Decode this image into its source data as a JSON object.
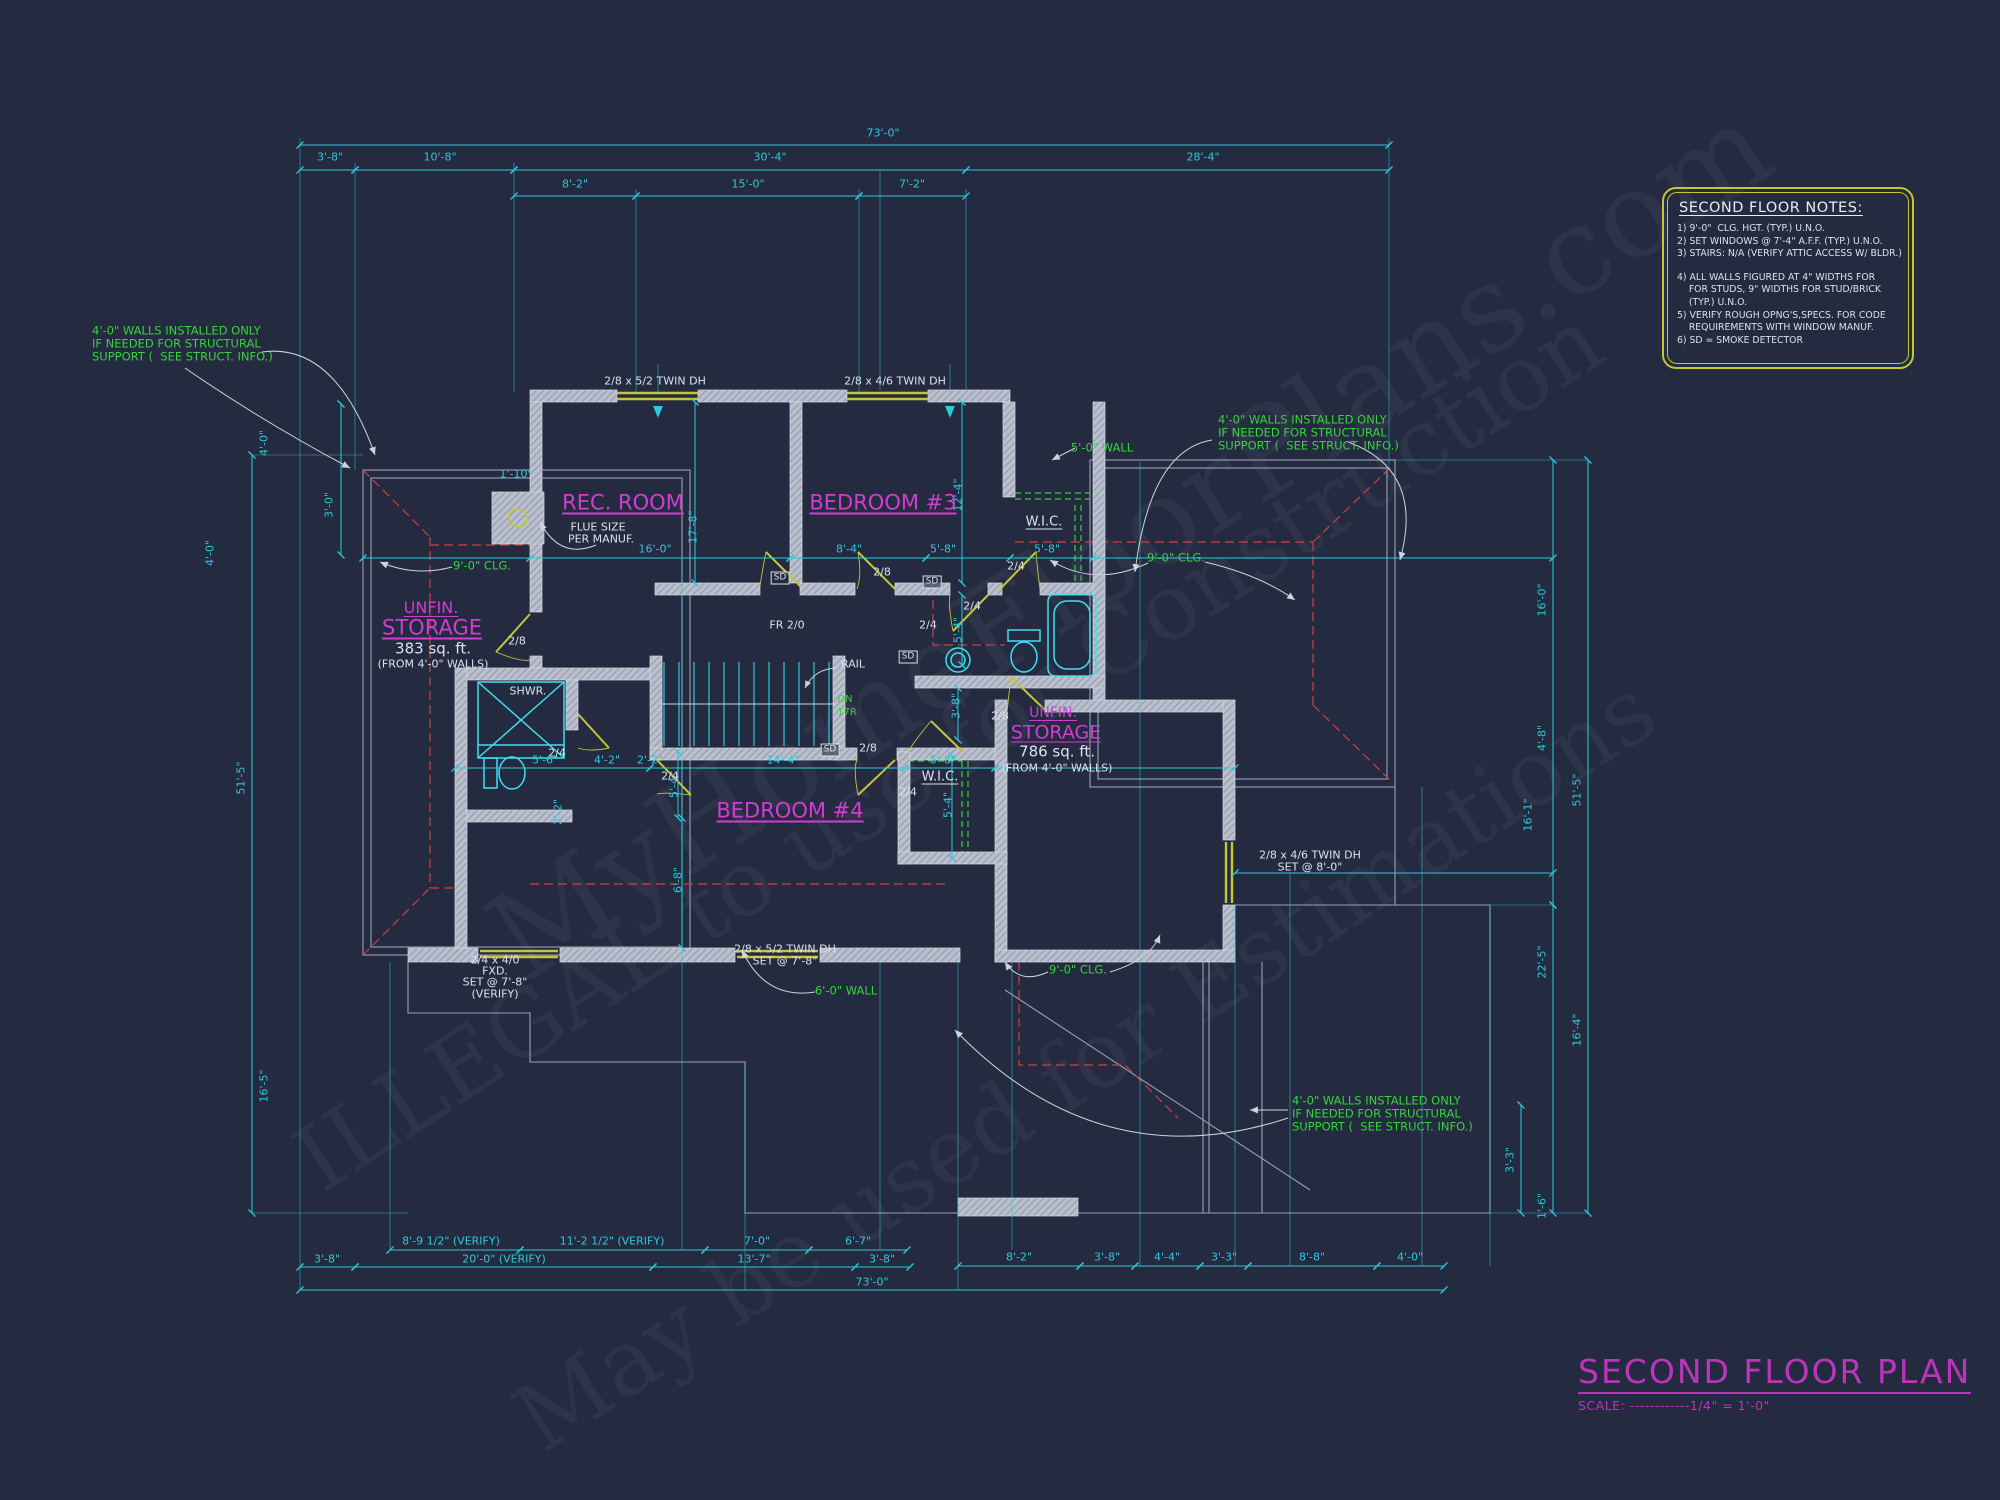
{
  "colors": {
    "background": "#242b40",
    "dimension_cyan": "#2cc8da",
    "label_white": "#dde1ec",
    "note_green": "#35d43a",
    "room_magenta": "#d33cd3",
    "door_window_yellow": "#c6c635",
    "ceiling_red": "#cf4040",
    "wall_gray": "#c2c7d4"
  },
  "title_block": {
    "title": "SECOND FLOOR PLAN",
    "scale": "SCALE: ------------1/4\" = 1'-0\""
  },
  "notes_box": {
    "title": "SECOND FLOOR NOTES:",
    "lines": [
      {
        "t": "1) 9'-0\"  CLG. HGT. (TYP.) U.N.O."
      },
      {
        "t": "2) SET WINDOWS @ 7'-4\" A.F.F. (TYP.) U.N.O."
      },
      {
        "t": "3) STAIRS: N/A (VERIFY ATTIC ACCESS W/ BLDR.)"
      },
      {
        "t": "4) ALL WALLS FIGURED AT 4\" WIDTHS FOR",
        "gap": true
      },
      {
        "t": "    FOR STUDS, 9\" WIDTHS FOR STUD/BRICK"
      },
      {
        "t": "    (TYP.) U.N.O."
      },
      {
        "t": "5) VERIFY ROUGH OPNG'S,SPECS. FOR CODE"
      },
      {
        "t": "    REQUIREMENTS WITH WINDOW MANUF."
      },
      {
        "t": "6) SD = SMOKE DETECTOR"
      }
    ]
  },
  "rooms": [
    {
      "t": "REC. ROOM",
      "x": 623,
      "y": 503,
      "f": 21,
      "cls": "ul",
      "n": "room-label-rec-room"
    },
    {
      "t": "BEDROOM #3",
      "x": 883,
      "y": 503,
      "f": 21,
      "cls": "ul",
      "n": "room-label-bedroom-3"
    },
    {
      "t": "BEDROOM #4",
      "x": 790,
      "y": 811,
      "f": 21,
      "cls": "ul",
      "n": "room-label-bedroom-4"
    },
    {
      "t": "UNFIN.",
      "x": 431,
      "y": 608,
      "f": 16,
      "cls": "ul",
      "n": "room-label-unfin-storage-left"
    },
    {
      "t": "STORAGE",
      "x": 432,
      "y": 628,
      "f": 21,
      "cls": "ul",
      "n": "room-label-unfin-storage-left"
    },
    {
      "t": "UNFIN.",
      "x": 1053,
      "y": 713,
      "f": 14,
      "cls": "ul",
      "n": "room-label-unfin-storage-right"
    },
    {
      "t": "STORAGE",
      "x": 1056,
      "y": 733,
      "f": 19,
      "cls": "ul",
      "n": "room-label-unfin-storage-right"
    }
  ],
  "white_labels": [
    {
      "t": "2/8 x 5/2 TWIN DH",
      "x": 655,
      "y": 381,
      "n": "window-spec"
    },
    {
      "t": "2/8 x 4/6 TWIN DH",
      "x": 895,
      "y": 381,
      "n": "window-spec"
    },
    {
      "t": "FLUE SIZE",
      "x": 598,
      "y": 527,
      "n": "flue-note"
    },
    {
      "t": "PER MANUF.",
      "x": 601,
      "y": 539,
      "n": "flue-note"
    },
    {
      "t": "SHWR.",
      "x": 528,
      "y": 691,
      "n": "fixture-label-shower"
    },
    {
      "t": "W.I.C.",
      "x": 1044,
      "y": 522,
      "f": 13,
      "cls": "ul",
      "n": "room-label-wic-1"
    },
    {
      "t": "W.I.C.",
      "x": 940,
      "y": 777,
      "f": 13,
      "cls": "ul",
      "n": "room-label-wic-2"
    },
    {
      "t": "RAIL",
      "x": 853,
      "y": 664,
      "n": "stair-rail-label"
    },
    {
      "t": "383 sq. ft.",
      "x": 433,
      "y": 649,
      "f": 15,
      "n": "area-label"
    },
    {
      "t": "(FROM 4'-0\" WALLS)",
      "x": 433,
      "y": 664,
      "n": "area-label"
    },
    {
      "t": "786 sq. ft.",
      "x": 1057,
      "y": 752,
      "f": 15,
      "n": "area-label"
    },
    {
      "t": "(FROM 4'-0\" WALLS)",
      "x": 1057,
      "y": 768,
      "n": "area-label"
    },
    {
      "t": "2/4 x 4/0",
      "x": 495,
      "y": 960,
      "n": "window-spec"
    },
    {
      "t": "FXD.",
      "x": 495,
      "y": 971,
      "n": "window-spec"
    },
    {
      "t": "SET @ 7'-8\"",
      "x": 495,
      "y": 982,
      "n": "window-spec"
    },
    {
      "t": "(VERIFY)",
      "x": 495,
      "y": 994,
      "n": "window-spec"
    },
    {
      "t": "2/8 x 5/2 TWIN DH",
      "x": 785,
      "y": 949,
      "n": "window-spec"
    },
    {
      "t": "SET @ 7'-8\"",
      "x": 785,
      "y": 961,
      "n": "window-spec"
    },
    {
      "t": "2/8 x 4/6 TWIN DH",
      "x": 1310,
      "y": 855,
      "n": "window-spec"
    },
    {
      "t": "SET @ 8'-0\"",
      "x": 1310,
      "y": 867,
      "n": "window-spec"
    },
    {
      "t": "2/8",
      "x": 517,
      "y": 641,
      "n": "door-size"
    },
    {
      "t": "2/8",
      "x": 882,
      "y": 572,
      "n": "door-size"
    },
    {
      "t": "2/4",
      "x": 1016,
      "y": 566,
      "n": "door-size"
    },
    {
      "t": "2/4",
      "x": 972,
      "y": 606,
      "n": "door-size"
    },
    {
      "t": "2/4",
      "x": 928,
      "y": 625,
      "n": "door-size"
    },
    {
      "t": "FR 2/0",
      "x": 787,
      "y": 625,
      "n": "door-size"
    },
    {
      "t": "2/8",
      "x": 868,
      "y": 748,
      "n": "door-size"
    },
    {
      "t": "2/8",
      "x": 1000,
      "y": 716,
      "n": "door-size"
    },
    {
      "t": "2/4",
      "x": 670,
      "y": 776,
      "n": "door-size"
    },
    {
      "t": "2/4",
      "x": 908,
      "y": 792,
      "n": "door-size"
    },
    {
      "t": "2/4",
      "x": 557,
      "y": 753,
      "n": "door-size"
    }
  ],
  "green_labels": [
    {
      "t": "9'-0\" CLG.",
      "x": 482,
      "y": 566,
      "n": "ceiling-note"
    },
    {
      "t": "9'-0\" CLG.",
      "x": 1176,
      "y": 558,
      "n": "ceiling-note"
    },
    {
      "t": "9'-0\" CLG.",
      "x": 1078,
      "y": 970,
      "n": "ceiling-note"
    },
    {
      "t": "5'-0\" WALL",
      "x": 1102,
      "y": 448,
      "n": "wall-height-note"
    },
    {
      "t": "6'-0\" WALL",
      "x": 846,
      "y": 991,
      "n": "wall-height-note"
    },
    {
      "t": "DN",
      "x": 845,
      "y": 700,
      "f": 10,
      "n": "stair-direction"
    },
    {
      "t": "17R",
      "x": 847,
      "y": 713,
      "f": 10,
      "n": "stair-risers"
    },
    {
      "t": "4'-0\" WALLS INSTALLED ONLY",
      "x": 92,
      "y": 331,
      "cls": "ta-l",
      "n": "structural-note"
    },
    {
      "t": "IF NEEDED FOR STRUCTURAL",
      "x": 92,
      "y": 344,
      "cls": "ta-l",
      "n": "structural-note"
    },
    {
      "t": "SUPPORT (  SEE STRUCT. INFO.)",
      "x": 92,
      "y": 357,
      "cls": "ta-l",
      "n": "structural-note"
    },
    {
      "t": "4'-0\" WALLS INSTALLED ONLY",
      "x": 1218,
      "y": 420,
      "cls": "ta-l",
      "n": "structural-note"
    },
    {
      "t": "IF NEEDED FOR STRUCTURAL",
      "x": 1218,
      "y": 433,
      "cls": "ta-l",
      "n": "structural-note"
    },
    {
      "t": "SUPPORT (  SEE STRUCT. INFO.)",
      "x": 1218,
      "y": 446,
      "cls": "ta-l",
      "n": "structural-note"
    },
    {
      "t": "4'-0\" WALLS INSTALLED ONLY",
      "x": 1292,
      "y": 1101,
      "cls": "ta-l",
      "n": "structural-note"
    },
    {
      "t": "IF NEEDED FOR STRUCTURAL",
      "x": 1292,
      "y": 1114,
      "cls": "ta-l",
      "n": "structural-note"
    },
    {
      "t": "SUPPORT (  SEE STRUCT. INFO.)",
      "x": 1292,
      "y": 1127,
      "cls": "ta-l",
      "n": "structural-note"
    }
  ],
  "dim_labels": [
    {
      "t": "73'-0\"",
      "x": 883,
      "y": 133
    },
    {
      "t": "3'-8\"",
      "x": 330,
      "y": 157
    },
    {
      "t": "10'-8\"",
      "x": 440,
      "y": 157
    },
    {
      "t": "30'-4\"",
      "x": 770,
      "y": 157
    },
    {
      "t": "28'-4\"",
      "x": 1203,
      "y": 157
    },
    {
      "t": "8'-2\"",
      "x": 575,
      "y": 184
    },
    {
      "t": "15'-0\"",
      "x": 748,
      "y": 184
    },
    {
      "t": "7'-2\"",
      "x": 912,
      "y": 184
    },
    {
      "t": "4'-0\"",
      "x": 264,
      "y": 443,
      "r": -90
    },
    {
      "t": "4'-0\"",
      "x": 210,
      "y": 553,
      "r": -90
    },
    {
      "t": "3'-0\"",
      "x": 329,
      "y": 505,
      "r": -90
    },
    {
      "t": "51'-5\"",
      "x": 241,
      "y": 778,
      "r": -90
    },
    {
      "t": "16'-5\"",
      "x": 264,
      "y": 1086,
      "r": -90
    },
    {
      "t": "16'-0\"",
      "x": 1542,
      "y": 600,
      "r": -90
    },
    {
      "t": "4'-8\"",
      "x": 1542,
      "y": 738,
      "r": -90
    },
    {
      "t": "16'-1\"",
      "x": 1528,
      "y": 815,
      "r": -90
    },
    {
      "t": "51'-5\"",
      "x": 1577,
      "y": 790,
      "r": -90
    },
    {
      "t": "22'-5\"",
      "x": 1542,
      "y": 962,
      "r": -90
    },
    {
      "t": "16'-4\"",
      "x": 1577,
      "y": 1030,
      "r": -90
    },
    {
      "t": "3'-3\"",
      "x": 1510,
      "y": 1160,
      "r": -90
    },
    {
      "t": "1'-6\"",
      "x": 1542,
      "y": 1206,
      "r": -90
    },
    {
      "t": "8'-9 1/2\" (VERIFY)",
      "x": 451,
      "y": 1241
    },
    {
      "t": "11'-2 1/2\" (VERIFY)",
      "x": 612,
      "y": 1241
    },
    {
      "t": "7'-0\"",
      "x": 757,
      "y": 1241
    },
    {
      "t": "6'-7\"",
      "x": 858,
      "y": 1241
    },
    {
      "t": "3'-8\"",
      "x": 327,
      "y": 1259
    },
    {
      "t": "20'-0\" (VERIFY)",
      "x": 504,
      "y": 1259
    },
    {
      "t": "13'-7\"",
      "x": 754,
      "y": 1259
    },
    {
      "t": "3'-8\"",
      "x": 882,
      "y": 1259
    },
    {
      "t": "8'-2\"",
      "x": 1019,
      "y": 1257
    },
    {
      "t": "3'-8\"",
      "x": 1107,
      "y": 1257
    },
    {
      "t": "4'-4\"",
      "x": 1167,
      "y": 1257
    },
    {
      "t": "3'-3\"",
      "x": 1224,
      "y": 1257
    },
    {
      "t": "8'-8\"",
      "x": 1312,
      "y": 1257
    },
    {
      "t": "4'-0\"",
      "x": 1410,
      "y": 1257
    },
    {
      "t": "73'-0\"",
      "x": 872,
      "y": 1282
    },
    {
      "t": "16'-0\"",
      "x": 655,
      "y": 549
    },
    {
      "t": "17'-8\"",
      "x": 693,
      "y": 527,
      "r": -90
    },
    {
      "t": "1'-10\"",
      "x": 516,
      "y": 474
    },
    {
      "t": "8'-4\"",
      "x": 849,
      "y": 549
    },
    {
      "t": "5'-8\"",
      "x": 943,
      "y": 549
    },
    {
      "t": "5'-8\"",
      "x": 1047,
      "y": 549
    },
    {
      "t": "12'-4\"",
      "x": 958,
      "y": 495,
      "r": -90
    },
    {
      "t": "5'-4\"",
      "x": 958,
      "y": 630,
      "r": -90
    },
    {
      "t": "3'-8\"",
      "x": 956,
      "y": 706,
      "r": -90
    },
    {
      "t": "14'-4\"",
      "x": 783,
      "y": 760
    },
    {
      "t": "5'-8\"",
      "x": 943,
      "y": 760
    },
    {
      "t": "5'-4\"",
      "x": 948,
      "y": 805,
      "r": -90
    },
    {
      "t": "5'-4\"",
      "x": 674,
      "y": 785,
      "r": -90
    },
    {
      "t": "6'-8\"",
      "x": 678,
      "y": 880,
      "r": -90
    },
    {
      "t": "5'-6\"",
      "x": 545,
      "y": 760
    },
    {
      "t": "4'-2\"",
      "x": 607,
      "y": 760
    },
    {
      "t": "2'-2\"",
      "x": 650,
      "y": 760
    },
    {
      "t": "2'-2\"",
      "x": 558,
      "y": 812,
      "r": -90
    }
  ],
  "sd_markers": [
    {
      "t": "SD",
      "x": 780,
      "y": 578
    },
    {
      "t": "SD",
      "x": 932,
      "y": 582
    },
    {
      "t": "SD",
      "x": 830,
      "y": 750
    },
    {
      "t": "SD",
      "x": 908,
      "y": 657
    }
  ],
  "watermarks": [
    {
      "t": "MyHomeFloorPlans.com",
      "x": 470,
      "y": 900,
      "r": -33,
      "f": 120,
      "c": 0,
      "n": "watermark-site"
    },
    {
      "t": "ILLEGAL to use for Construction",
      "x": 280,
      "y": 1130,
      "r": -33,
      "f": 92,
      "c": 0,
      "n": "watermark-illegal"
    },
    {
      "t": "May be used for Estimations",
      "x": 500,
      "y": 1390,
      "r": -33,
      "f": 92,
      "c": 0,
      "n": "watermark-estimations"
    }
  ]
}
